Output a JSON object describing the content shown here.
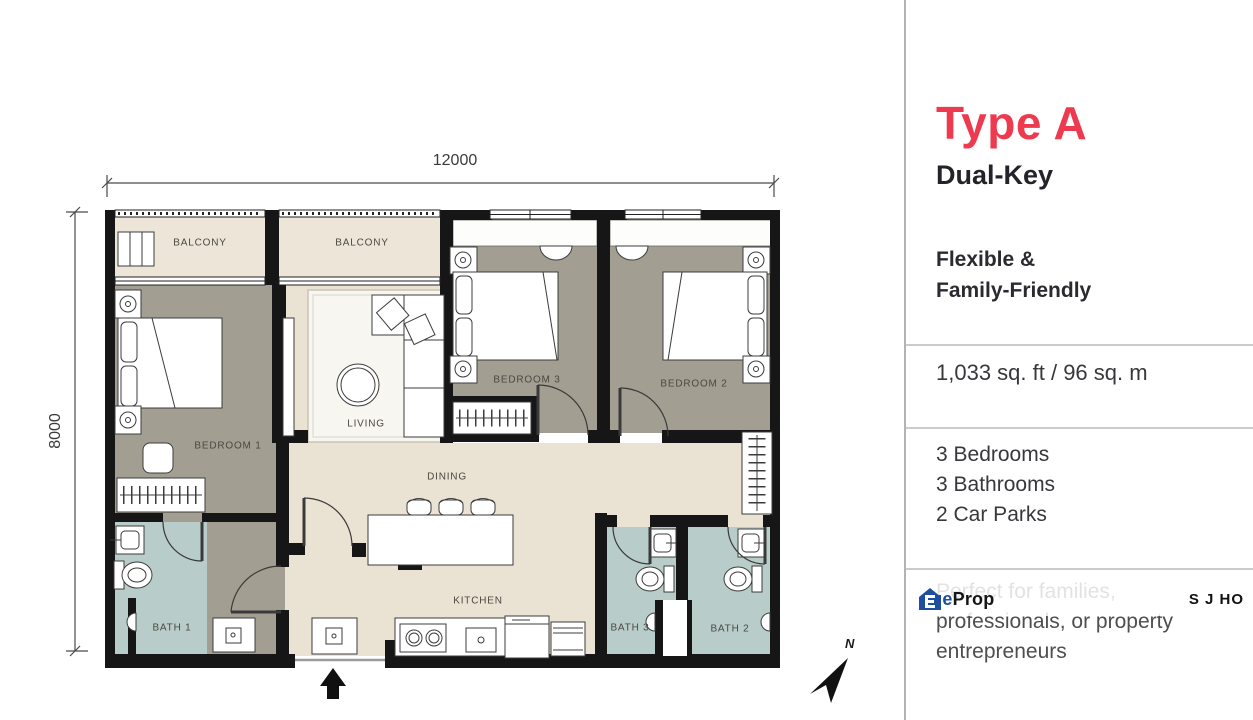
{
  "plan": {
    "dim_width": "12000",
    "dim_height": "8000",
    "north": "N",
    "rooms": {
      "balcony1": "BALCONY",
      "balcony2": "BALCONY",
      "bedroom1": "BEDROOM 1",
      "bedroom2": "BEDROOM 2",
      "bedroom3": "BEDROOM 3",
      "living": "LIVING",
      "dining": "DINING",
      "kitchen": "KITCHEN",
      "bath1": "BATH 1",
      "bath2": "BATH 2",
      "bath3": "BATH 3"
    }
  },
  "panel": {
    "title": "Type A",
    "subtitle": "Dual-Key",
    "tagline1": "Flexible &",
    "tagline2": "Family-Friendly",
    "area": "1,033 sq. ft / 96 sq. m",
    "features": [
      "3 Bedrooms",
      "3 Bathrooms",
      "2 Car Parks"
    ],
    "desc": [
      "Perfect for families,",
      "professionals, or property",
      "entrepreneurs"
    ],
    "colors": {
      "accent": "#ed3a4f",
      "logo_blue": "#1d4f9e",
      "bedroom_floor": "#a39e92",
      "bath_floor": "#b8cdc9",
      "living_floor": "#eae2d3",
      "wall": "#161616"
    }
  },
  "watermark": {
    "logo_letter": "E",
    "logo_part1": "dge",
    "logo_part2": "Prop",
    "initials": "S J HO"
  }
}
